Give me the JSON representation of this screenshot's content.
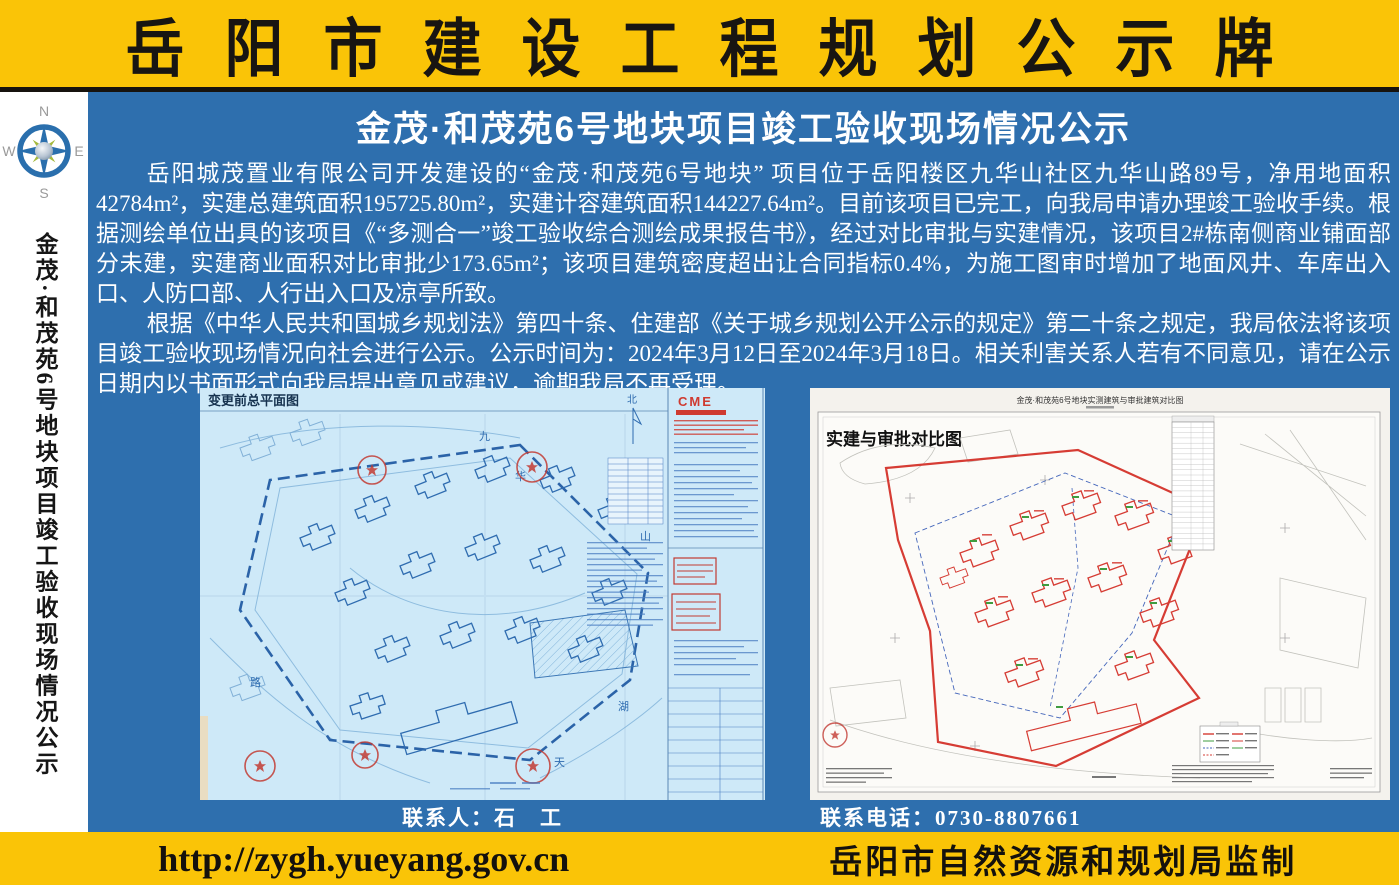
{
  "header": {
    "title": "岳阳市建设工程规划公示牌"
  },
  "sidebar": {
    "compass": {
      "north": "N",
      "east": "E",
      "south": "S",
      "west": "W"
    },
    "vertical_title": "金茂·和茂苑6号地块项目竣工验收现场情况公示"
  },
  "main": {
    "subtitle": "金茂·和茂苑6号地块项目竣工验收现场情况公示",
    "paragraphs": {
      "p1": "岳阳城茂置业有限公司开发建设的“金茂·和茂苑6号地块” 项目位于岳阳楼区九华山社区九华山路89号，净用地面积42784m²，实建总建筑面积195725.80m²，实建计容建筑面积144227.64m²。目前该项目已完工，向我局申请办理竣工验收手续。根据测绘单位出具的该项目《“多测合一”竣工验收综合测绘成果报告书》，经过对比审批与实建情况，该项目2#栋南侧商业铺面部分未建，实建商业面积对比审批少173.65m²；该项目建筑密度超出让合同指标0.4%，为施工图审时增加了地面风井、车库出入口、人防口部、人行出入口及凉亭所致。",
      "p2": "根据《中华人民共和国城乡规划法》第四十条、住建部《关于城乡规划公开公示的规定》第二十条之规定，我局依法将该项目竣工验收现场情况向社会进行公示。公示时间为：2024年3月12日至2024年3月18日。相关利害关系人若有不同意见，请在公示日期内以书面形式向我局提出意见或建议，逾期我局不再受理。"
    },
    "left_plan": {
      "label": "变更前总平面图",
      "logo": "CME",
      "north_char": "北",
      "street_chars": [
        "九",
        "华",
        "山",
        "路",
        "天",
        "湖"
      ],
      "caption": "联系人：石　工"
    },
    "right_plan": {
      "label": "实建与审批对比图",
      "title": "金茂·和茂苑6号地块实测建筑与审批建筑对比图",
      "caption": "联系电话：0730-8807661"
    }
  },
  "footer": {
    "url": "http://zygh.yueyang.gov.cn",
    "issuer": "岳阳市自然资源和规划局监制"
  },
  "colors": {
    "banner_yellow": "#FAC407",
    "main_blue": "#2E6FAE",
    "blueprint_bg": "#CEE9F8",
    "blueprint_line": "#2F6CB0",
    "plan_red": "#D63C34",
    "stamp_red": "#C23A32",
    "annotation_green": "#3F9C3F"
  }
}
